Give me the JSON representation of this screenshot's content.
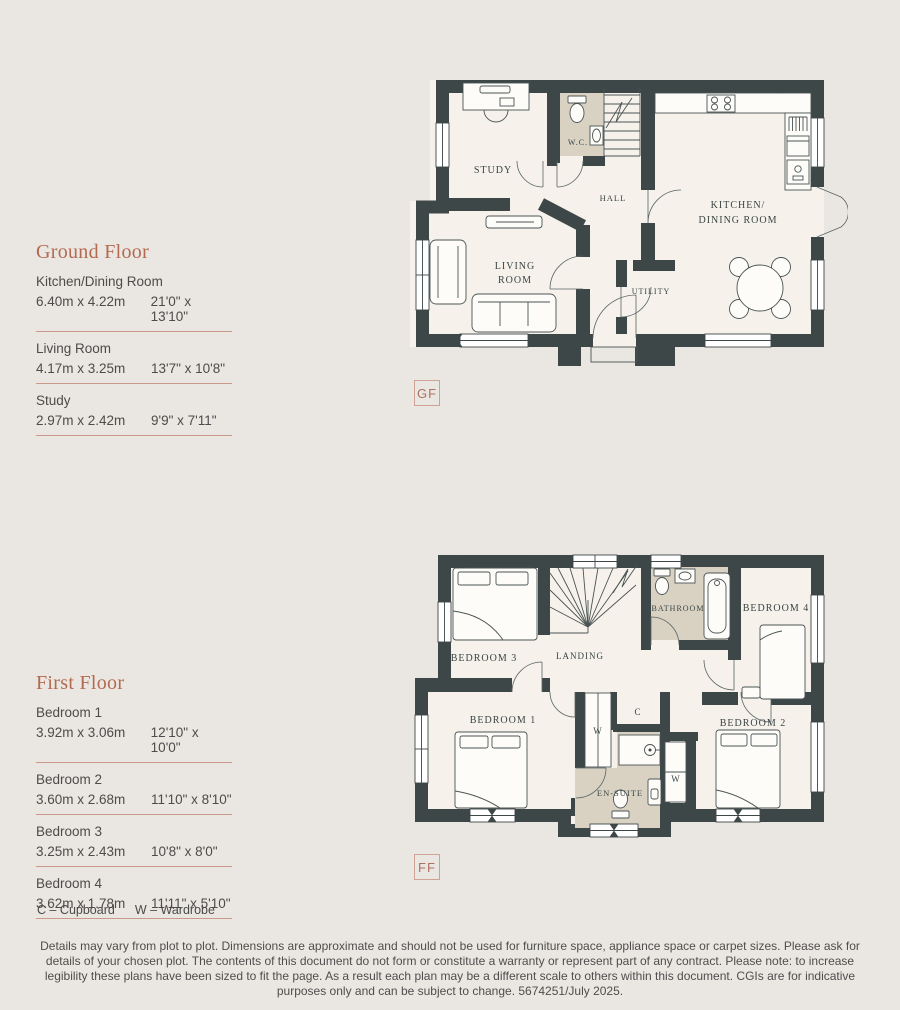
{
  "palette": {
    "page_background": "#eae6e1",
    "plan_floor": "#f6f2eb",
    "wet_room_floor": "#d9d2c3",
    "wall": "#3d4747",
    "accent_heading": "#b46a50",
    "rule_line": "#c9998c",
    "body_text": "#4c4c4c",
    "tag_border": "#d0a195"
  },
  "ground_floor": {
    "heading": "Ground Floor",
    "tag": "GF",
    "rooms": [
      {
        "name": "Kitchen/Dining Room",
        "metric": "6.40m x 4.22m",
        "imperial": "21'0\" x 13'10\""
      },
      {
        "name": "Living Room",
        "metric": "4.17m x 3.25m",
        "imperial": "13'7\" x 10'8\""
      },
      {
        "name": "Study",
        "metric": "2.97m x 2.42m",
        "imperial": "9'9\" x 7'11\""
      }
    ],
    "plan_labels": {
      "study": "STUDY",
      "wc": "W.C.",
      "hall": "HALL",
      "kitchen1": "KITCHEN/",
      "kitchen2": "DINING ROOM",
      "living1": "LIVING",
      "living2": "ROOM",
      "utility": "UTILITY"
    }
  },
  "first_floor": {
    "heading": "First Floor",
    "tag": "FF",
    "rooms": [
      {
        "name": "Bedroom 1",
        "metric": "3.92m x 3.06m",
        "imperial": "12'10\" x 10'0\""
      },
      {
        "name": "Bedroom 2",
        "metric": "3.60m x 2.68m",
        "imperial": "11'10\" x 8'10\""
      },
      {
        "name": "Bedroom 3",
        "metric": "3.25m x 2.43m",
        "imperial": "10'8\" x 8'0\""
      },
      {
        "name": "Bedroom 4",
        "metric": "3.62m x 1.78m",
        "imperial": "11'11\" x 5'10\""
      }
    ],
    "plan_labels": {
      "bedroom1": "BEDROOM 1",
      "bedroom2": "BEDROOM 2",
      "bedroom3": "BEDROOM 3",
      "bedroom4": "BEDROOM 4",
      "landing": "LANDING",
      "bathroom": "BATHROOM",
      "ensuite": "EN-SUITE",
      "cupboard": "C",
      "wardrobe1": "W",
      "wardrobe2": "W"
    }
  },
  "legend": {
    "item1": "C – Cupboard",
    "item2": "W – Wardrobe"
  },
  "disclaimer": "Details may vary from plot to plot. Dimensions are approximate and should not be used for furniture space, appliance space or carpet sizes. Please ask for details of your chosen plot. The contents of this document do not form or constitute a warranty or represent part of any contract. Please note: to increase legibility these plans have been sized to fit the page. As a result each plan may be a different scale to others within this document. CGIs are for indicative purposes only and can be subject to change. 5674251/July 2025."
}
